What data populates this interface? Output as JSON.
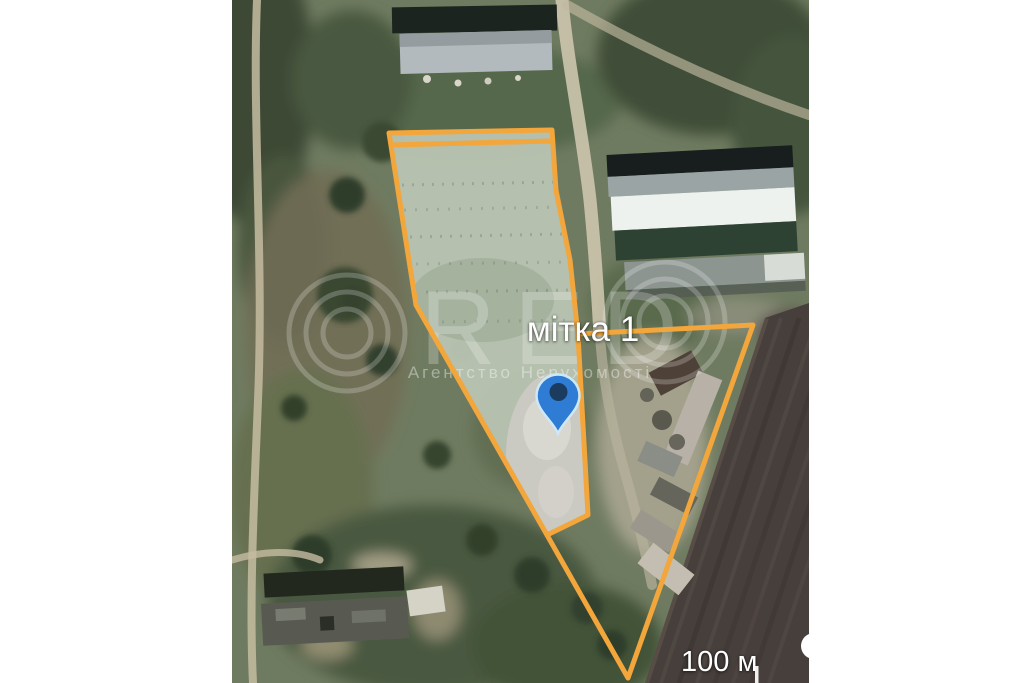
{
  "map": {
    "marker_label": "мітка 1",
    "scale_label": "100 м",
    "watermark": {
      "letters": "RED",
      "subtitle": "Агентство Нерухомості"
    },
    "colors": {
      "parcel_outline": "#F2A63B",
      "pin_fill": "#2E7CD4",
      "pin_core": "#1B3C5F",
      "pin_stroke": "#CFE8F7",
      "field_dark": "#473F3B",
      "terrain_green": "#6F7B60"
    }
  }
}
